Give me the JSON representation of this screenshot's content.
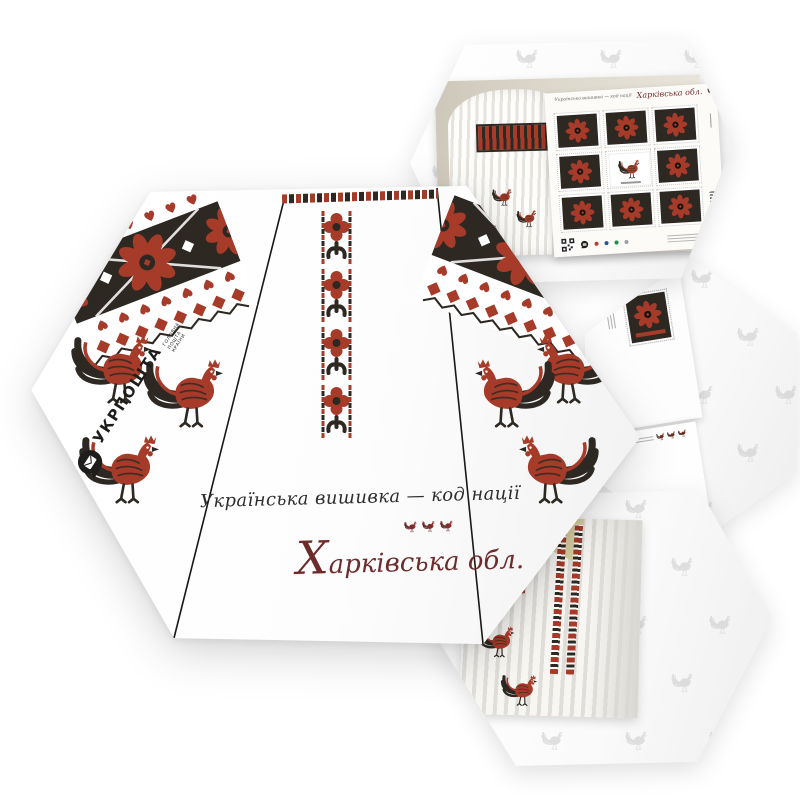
{
  "colors": {
    "embroidery_red": "#a63b2a",
    "embroidery_dark": "#2e2822",
    "region_maroon": "#6e2b2b",
    "tagline_black": "#2d2d2d",
    "watermark_gray": "#bfbfbf",
    "stamp_sheet_dots": [
      "#c0392b",
      "#2457a0",
      "#1f8e4d",
      "#9aa0a6"
    ]
  },
  "main_card": {
    "tagline": "Українська вишивка —  код нації",
    "region": "Харківська обл.",
    "logo_name": "УКРПОШТА",
    "logo_tagline": "ГОЛОВНА ПОШТА КРАЇНИ"
  },
  "stamp_sheet": {
    "header_tagline": "Українська вишивка — код нації",
    "header_region": "Харківська обл."
  }
}
